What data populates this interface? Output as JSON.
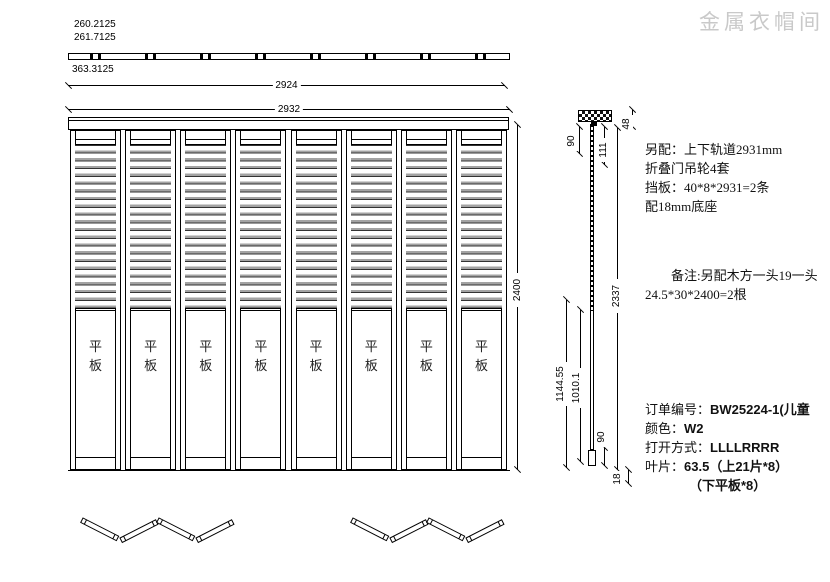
{
  "watermark": "金属衣帽间",
  "top_dims": {
    "d1": "260.2125",
    "d2": "261.7125",
    "d3": "363.3125",
    "d4": "2924",
    "d5": "2932"
  },
  "elevation": {
    "panel_label": "平板",
    "height": "2400"
  },
  "section": {
    "top_offset": "90",
    "hanger_height": "111",
    "top_gap": "48",
    "blade_length": "2337",
    "mid1": "1144.55",
    "mid2": "1010.1",
    "bottom_offset": "90",
    "base_height": "18"
  },
  "notes": {
    "accessories": [
      "另配：上下轨道2931mm",
      "折叠门吊轮4套",
      "挡板：40*8*2931=2条",
      "配18mm底座"
    ],
    "remark": [
      "备注:另配木方一头19一头",
      "24.5*30*2400=2根"
    ]
  },
  "order": {
    "no_label": "订单编号：",
    "no_value": "BW25224-1(儿童",
    "color_label": "颜色：",
    "color_value": "W2",
    "open_label": "打开方式：",
    "open_value": "LLLLRRRR",
    "blade_label": "叶片：",
    "blade_value": "63.5（上21片*8）",
    "blade_value2": "（下平板*8）"
  }
}
